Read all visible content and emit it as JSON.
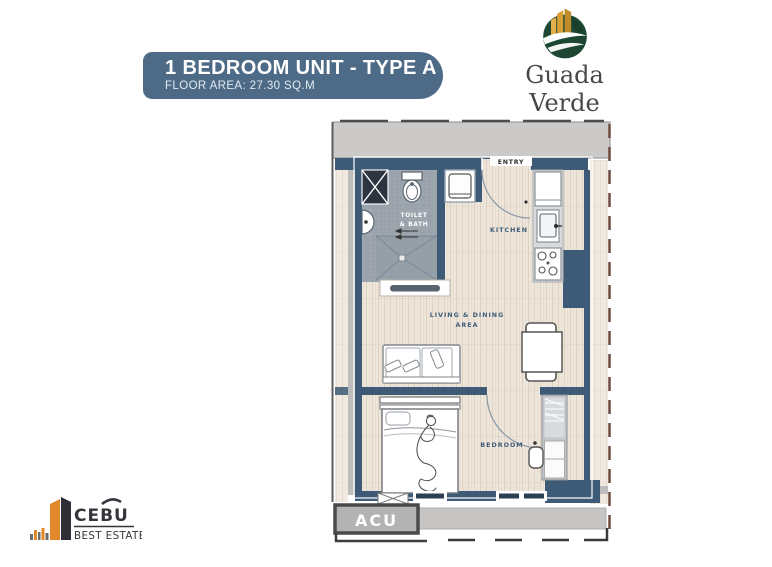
{
  "header": {
    "title": "1 BEDROOM UNIT - TYPE A",
    "subtitle": "FLOOR AREA: 27.30 SQ.M"
  },
  "brand": {
    "name": "Guada Verde",
    "towers": "TOWERS",
    "tagline": "Your Inner City Sanctuary"
  },
  "plan": {
    "entry": "ENTRY",
    "toilet1": "TOILET",
    "toilet2": "& BATH",
    "kitchen": "KITCHEN",
    "living1": "LIVING & DINING",
    "living2": "AREA",
    "bedroom": "BEDROOM",
    "acu": "ACU"
  },
  "footer": {
    "name": "CEBU",
    "tag": "BEST ESTATE"
  },
  "colors": {
    "banner": "#4d6b87",
    "wall": "#3d5a76",
    "corridor": "#cbcac8",
    "floor_wood": "#eee6da",
    "tile": "#9aa2ab",
    "logo_green": "#1d4732",
    "logo_gold": "#c08c2b",
    "cebu_orange": "#e0882a"
  }
}
